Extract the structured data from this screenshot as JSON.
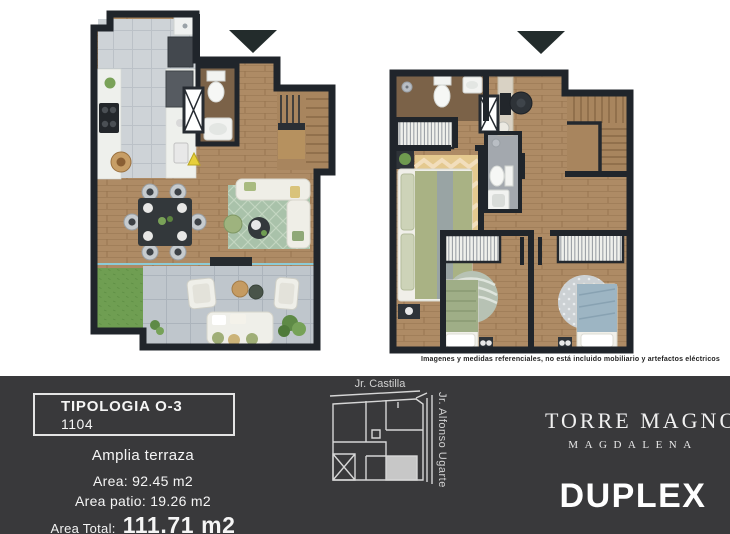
{
  "disclaimer": "Imagenes y medidas referenciales, no está incluido mobiliario y artefactos eléctricos",
  "footer": {
    "typology": {
      "title": "TIPOLOGIA O-3",
      "unit_number": "1104"
    },
    "details": {
      "feature": "Amplia terraza",
      "area_line": "Area: 92.45 m2",
      "patio_line": "Area patio: 19.26 m2",
      "total_label": "Area Total:",
      "total_value": "111.71 m2"
    },
    "sitemap": {
      "street_top": "Jr. Castilla",
      "street_right": "Jr. Alfonso Ugarte"
    },
    "brand": {
      "name": "TORRE MAGNO",
      "district": "MAGDALENA",
      "unit_type": "DUPLEX"
    }
  },
  "plans": {
    "left_marker_icon": "down-triangle",
    "right_marker_icon": "down-triangle",
    "elevator_icon": "x-cross-box"
  },
  "colors": {
    "footer_bg": "#39393b",
    "wall": "#20252b",
    "wood_floor": "#ae8b65",
    "kitchen_tile": "#ced3d7",
    "terrace_tile": "#bfc6cc",
    "grass": "#6f9e52",
    "marker": "#232c2c",
    "map_highlight": "#c7c7c7"
  }
}
